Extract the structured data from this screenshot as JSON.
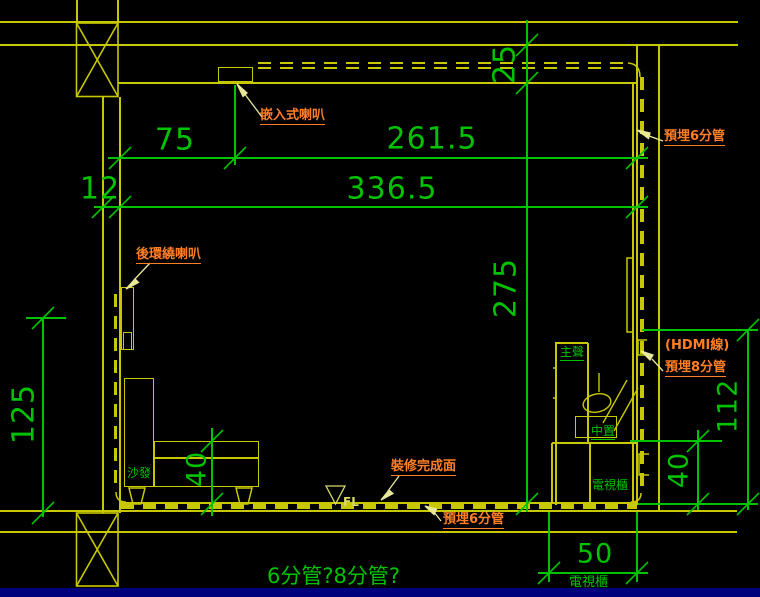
{
  "colors": {
    "background": "#000000",
    "wall_yellow": "#c8c800",
    "dimension_green": "#00c300",
    "label_orange": "#ff7f27",
    "leader_pale_yellow": "#e8e89c",
    "fl_symbol_yellow": "#d9d96e",
    "bottom_bar_blue": "#00007d"
  },
  "dimensions": {
    "wall_offset": "12",
    "speaker_offset": "75",
    "speaker_to_wall": "261.5",
    "room_width": "336.5",
    "ceiling_gap": "25",
    "room_height": "275",
    "rear_speaker_height": "125",
    "sofa_seat_height": "40",
    "cabinet_height": "40",
    "outlet_height": "112",
    "cabinet_depth": "50"
  },
  "labels": {
    "ceiling_speaker": "嵌入式喇叭",
    "conduit6_top": "預埋6分管",
    "rear_surround_speaker": "後環繞喇叭",
    "hdmi_cable": "(HDMI線)",
    "conduit8": "預埋8分管",
    "finish_surface": "裝修完成面",
    "conduit6_bottom": "預埋6分管",
    "question_note": "6分管?8分管?"
  },
  "furniture": {
    "sofa": "沙發",
    "main_speaker": "主聲",
    "center_speaker": "中置",
    "tv_cabinet": "電視櫃",
    "tv_cabinet_below": "電視櫃",
    "floor_level": "FL"
  }
}
